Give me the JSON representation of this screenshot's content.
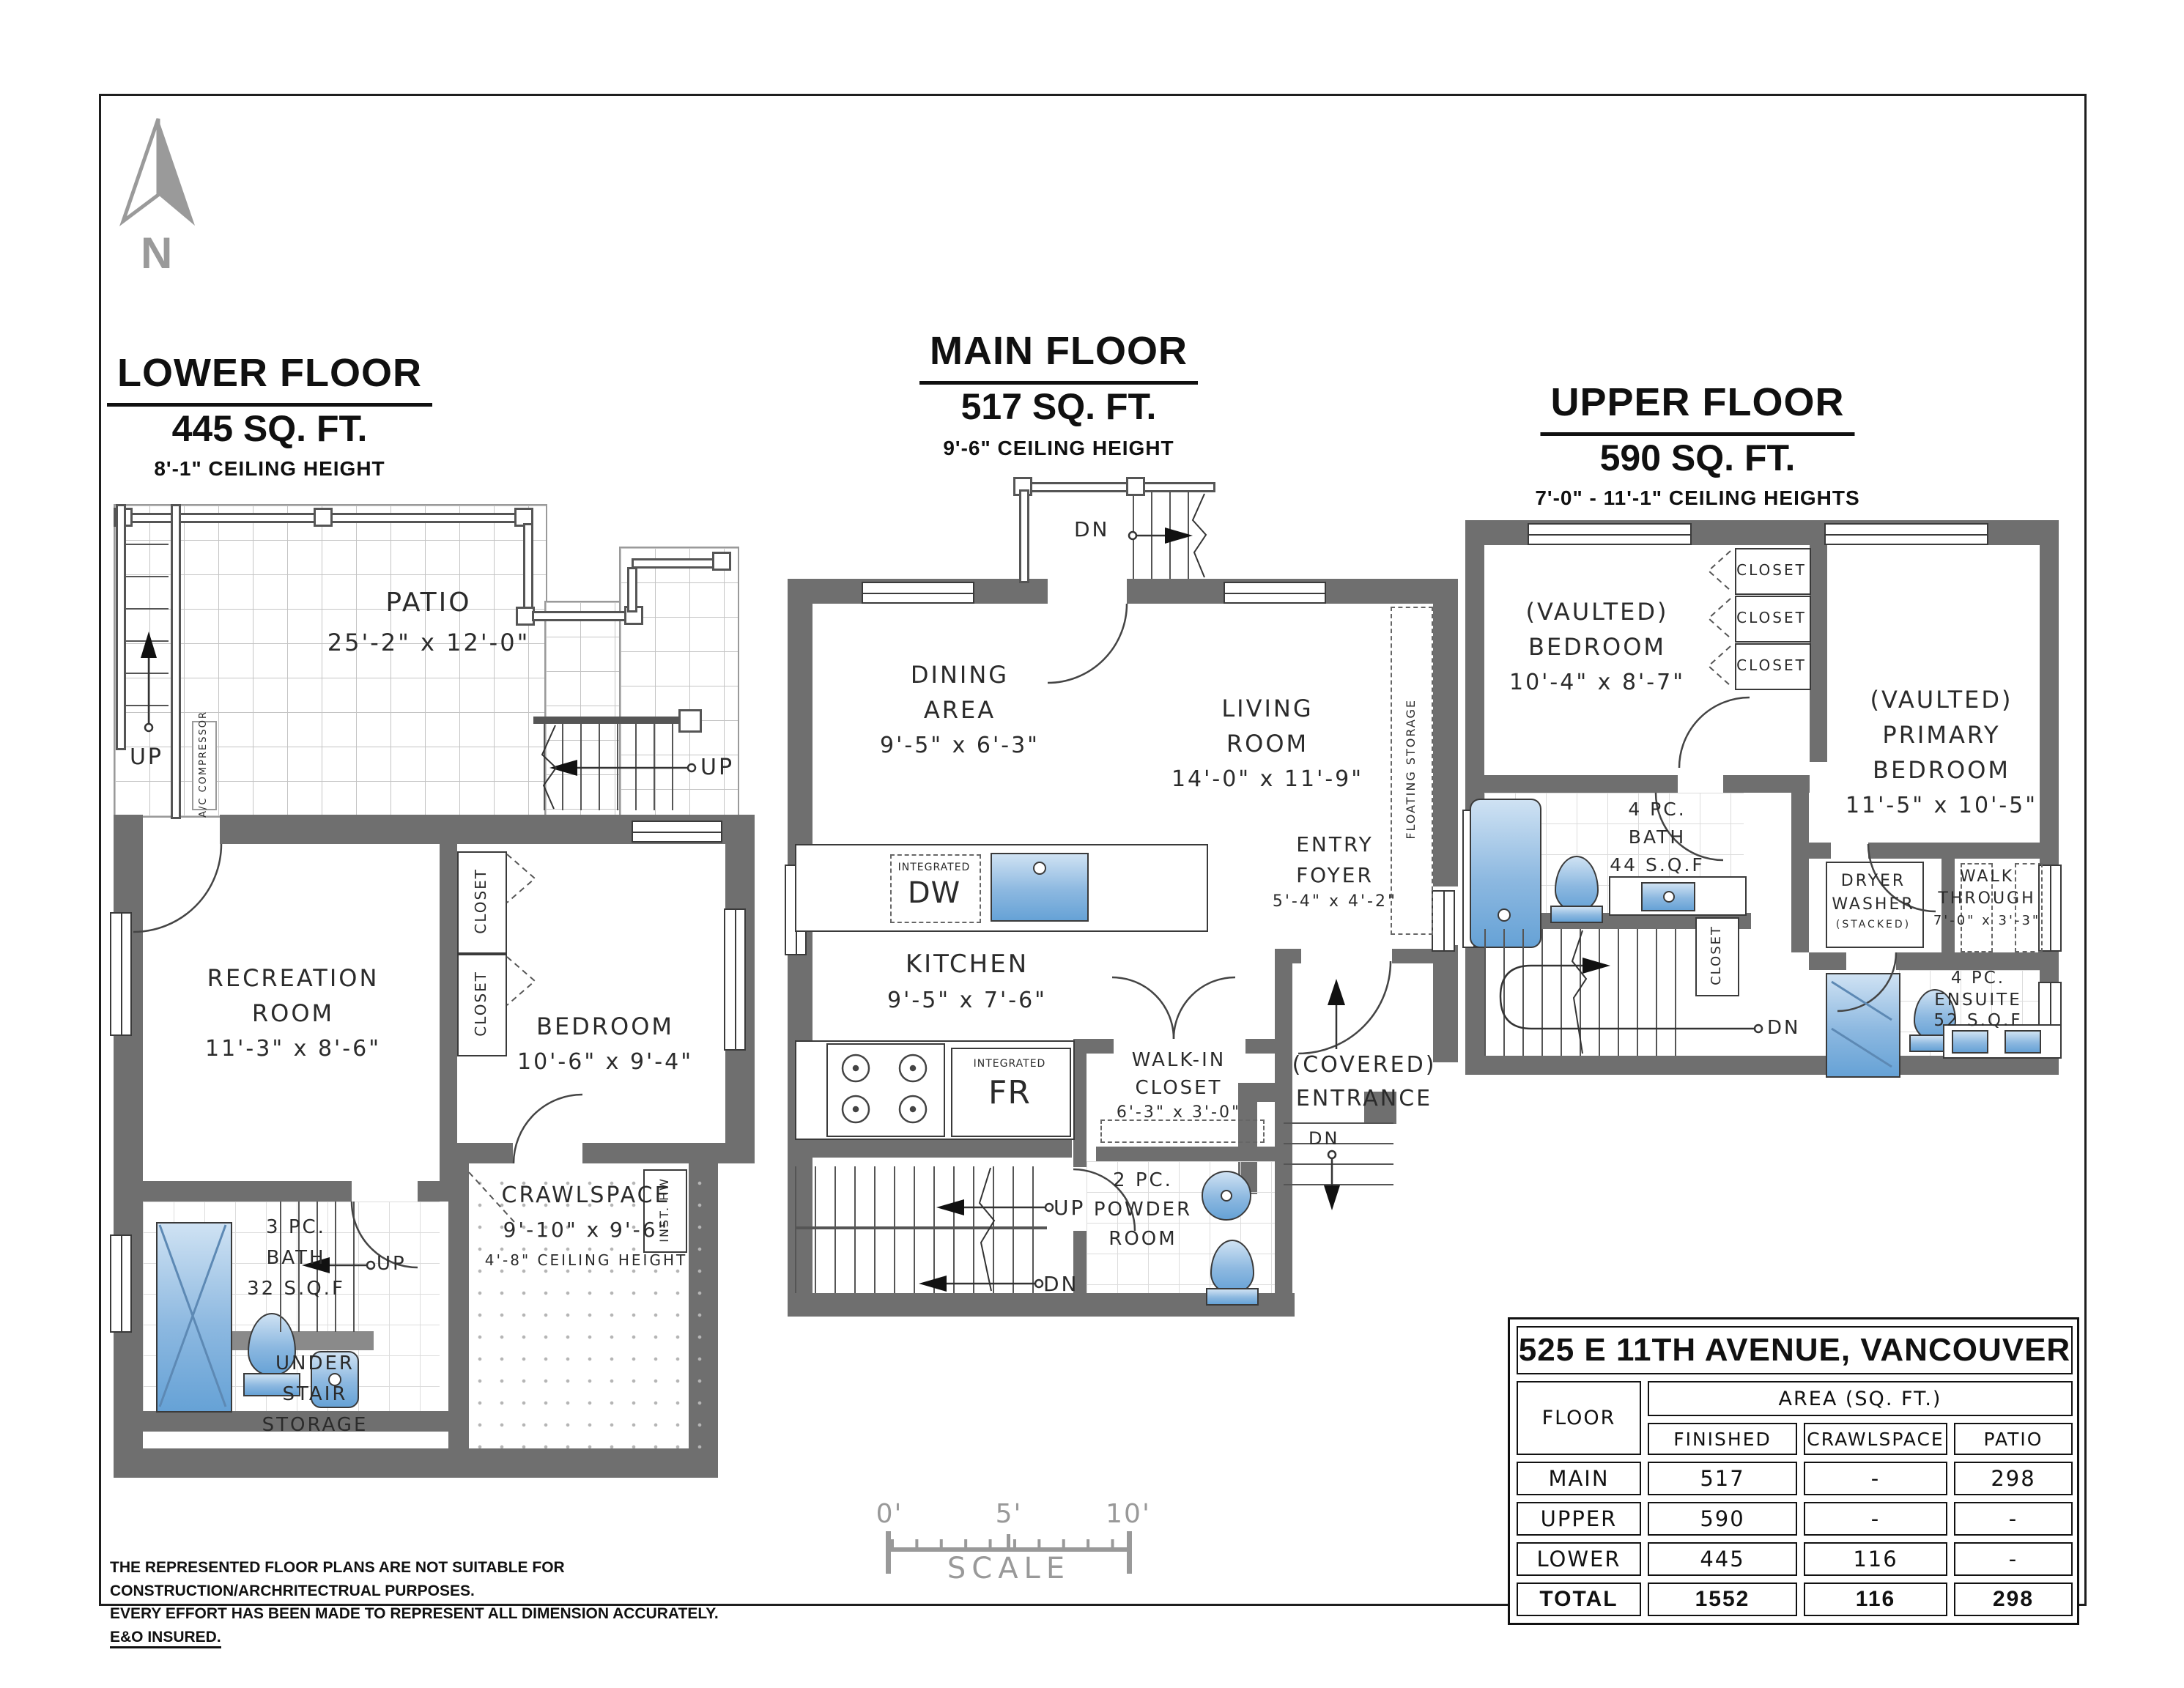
{
  "north": {
    "label": "N"
  },
  "floors": {
    "lower": {
      "title": "LOWER FLOOR",
      "area": "445 SQ. FT.",
      "ceiling": "8'-1\" CEILING HEIGHT",
      "patio": {
        "name": "PATIO",
        "dims": "25'-2\" x 12'-0\""
      },
      "recreation": {
        "l1": "RECREATION",
        "l2": "ROOM",
        "dims": "11'-3\" x 8'-6\""
      },
      "bedroom": {
        "l1": "BEDROOM",
        "dims": "10'-6\" x 9'-4\""
      },
      "closet_a": "CLOSET",
      "closet_b": "CLOSET",
      "bath": {
        "l1": "3 PC.",
        "l2": "BATH",
        "l3": "32 S.Q.F"
      },
      "crawlspace": {
        "l1": "CRAWLSPACE",
        "dims": "9'-10\" x 9'-6\"",
        "l3": "4'-8\" CEILING HEIGHT"
      },
      "storage": {
        "l1": "UNDER",
        "l2": "STAIR",
        "l3": "STORAGE"
      },
      "ac": "A/C COMPRESSOR",
      "inst_hw": "INST. HW",
      "up1": "UP",
      "up2": "UP",
      "up3": "UP"
    },
    "main": {
      "title": "MAIN FLOOR",
      "area": "517 SQ. FT.",
      "ceiling": "9'-6\" CEILING HEIGHT",
      "dining": {
        "l1": "DINING",
        "l2": "AREA",
        "dims": "9'-5\" x 6'-3\""
      },
      "living": {
        "l1": "LIVING",
        "l2": "ROOM",
        "dims": "14'-0\" x 11'-9\""
      },
      "kitchen": {
        "l1": "KITCHEN",
        "dims": "9'-5\" x 7'-6\""
      },
      "dw": {
        "l1": "INTEGRATED",
        "l2": "DW"
      },
      "fr": {
        "l1": "INTEGRATED",
        "l2": "FR"
      },
      "walkin": {
        "l1": "WALK-IN",
        "l2": "CLOSET",
        "dims": "6'-3\" x 3'-0\""
      },
      "powder": {
        "l1": "2 PC.",
        "l2": "POWDER",
        "l3": "ROOM"
      },
      "foyer": {
        "l1": "ENTRY",
        "l2": "FOYER",
        "dims": "5'-4\" x 4'-2\""
      },
      "entrance": {
        "l1": "(COVERED)",
        "l2": "ENTRANCE"
      },
      "floating": "FLOATING STORAGE",
      "dn_deck": "DN",
      "up": "UP",
      "dn": "DN",
      "dn_steps": "DN"
    },
    "upper": {
      "title": "UPPER FLOOR",
      "area": "590 SQ. FT.",
      "ceiling": "7'-0\" - 11'-1\" CEILING HEIGHTS",
      "bedroom": {
        "l1": "(VAULTED)",
        "l2": "BEDROOM",
        "dims": "10'-4\" x 8'-7\""
      },
      "primary": {
        "l1": "(VAULTED)",
        "l2": "PRIMARY",
        "l3": "BEDROOM",
        "dims": "11'-5\" x 10'-5\""
      },
      "closet1": "CLOSET",
      "closet2": "CLOSET",
      "closet3": "CLOSET",
      "bath": {
        "l1": "4 PC.",
        "l2": "BATH",
        "l3": "44 S.Q.F"
      },
      "laundry": {
        "l1": "DRYER",
        "l2": "WASHER",
        "l3": "(STACKED)"
      },
      "walkthrough": {
        "l1": "WALK",
        "l2": "THROUGH",
        "dims": "7'-0\" x 3'-3\""
      },
      "ensuite": {
        "l1": "4 PC.",
        "l2": "ENSUITE",
        "l3": "52 S.Q.F"
      },
      "closet_stair": "CLOSET",
      "dn": "DN"
    }
  },
  "summary_table": {
    "title": "525 E 11TH AVENUE, VANCOUVER",
    "col_floor": "FLOOR",
    "col_area": "AREA (SQ. FT.)",
    "col_finished": "FINISHED",
    "col_crawlspace": "CRAWLSPACE",
    "col_patio": "PATIO",
    "rows": [
      {
        "floor": "MAIN",
        "finished": "517",
        "crawlspace": "-",
        "patio": "298"
      },
      {
        "floor": "UPPER",
        "finished": "590",
        "crawlspace": "-",
        "patio": "-"
      },
      {
        "floor": "LOWER",
        "finished": "445",
        "crawlspace": "116",
        "patio": "-"
      },
      {
        "floor": "TOTAL",
        "finished": "1552",
        "crawlspace": "116",
        "patio": "298"
      }
    ]
  },
  "scale_bar": {
    "t0": "0'",
    "t5": "5'",
    "t10": "10'",
    "label": "SCALE"
  },
  "disclaimer": {
    "line1": "THE REPRESENTED FLOOR PLANS ARE NOT SUITABLE FOR CONSTRUCTION/ARCHRITECTRUAL PURPOSES.",
    "line2": "EVERY EFFORT HAS BEEN MADE TO REPRESENT ALL DIMENSION ACCURATELY.",
    "line2_underlined": "E&O INSURED."
  },
  "colors": {
    "wall": "#6f6f6f",
    "fixture_blue": "#66a2d6",
    "linework": "#444444",
    "muted": "#999999"
  }
}
